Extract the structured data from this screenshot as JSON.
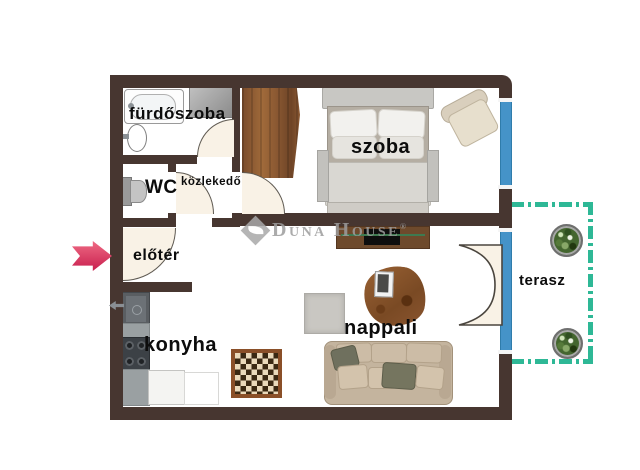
{
  "rooms": [
    {
      "name": "furdoszoba",
      "label": "fürdőszoba"
    },
    {
      "name": "wc",
      "label": "WC"
    },
    {
      "name": "kozlekedo",
      "label": "közlekedő"
    },
    {
      "name": "eloter",
      "label": "előtér"
    },
    {
      "name": "konyha",
      "label": "konyha"
    },
    {
      "name": "szoba",
      "label": "szoba"
    },
    {
      "name": "nappali",
      "label": "nappali"
    },
    {
      "name": "terasz",
      "label": "terasz"
    }
  ],
  "watermark": {
    "part1": "D",
    "part2": "UNA",
    "part3": "H",
    "part4": "OUSE",
    "registered": "®"
  },
  "colors": {
    "wall": "#473630",
    "window_blue": "#4593c8",
    "terrace_dash": "#2eb896",
    "entrance_arrow": "#d83a62",
    "wood": "#8a5a36",
    "door_fill": "#f9f2e6",
    "watermark_gray": "#9d9d9d"
  }
}
